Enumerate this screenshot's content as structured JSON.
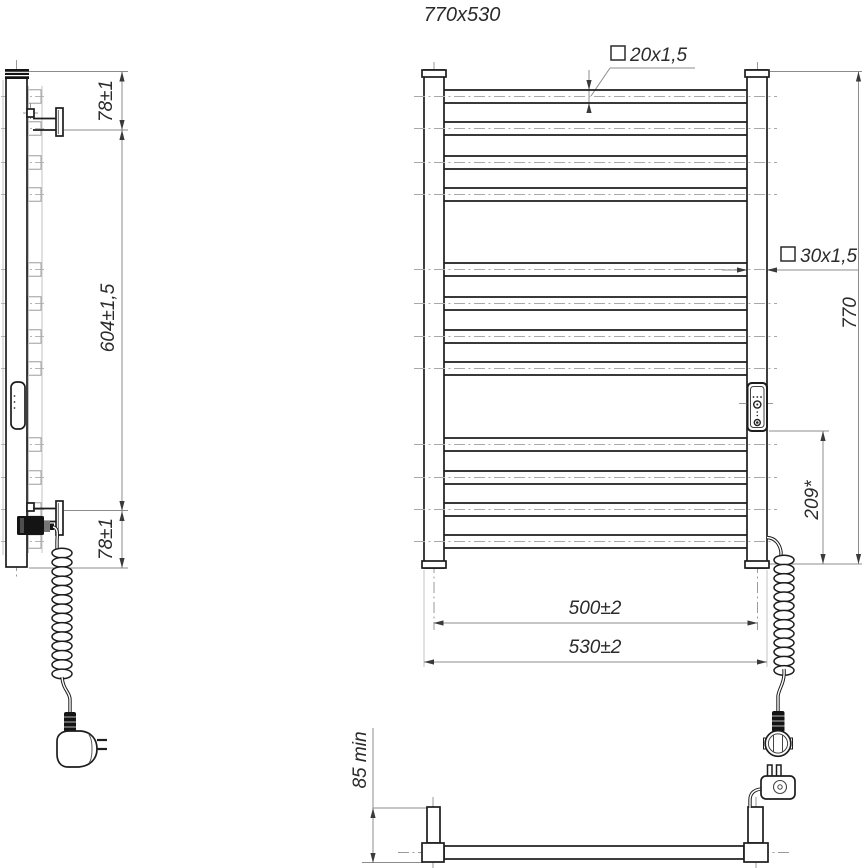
{
  "title": "770x530",
  "front_view": {
    "rung_tube_label": "20x1,5",
    "post_tube_label": "30x1,5",
    "height_dim": "770",
    "heater_offset_dim": "209*",
    "mounting_width_dim": "500±2",
    "overall_width_dim": "530±2"
  },
  "side_view": {
    "top_bracket_dim": "78±1",
    "bracket_spacing_dim": "604±1,5",
    "bottom_bracket_dim": "78±1"
  },
  "bottom_view": {
    "wall_clearance_dim": "85 min"
  },
  "icons": {
    "square_section_symbol": "□"
  }
}
